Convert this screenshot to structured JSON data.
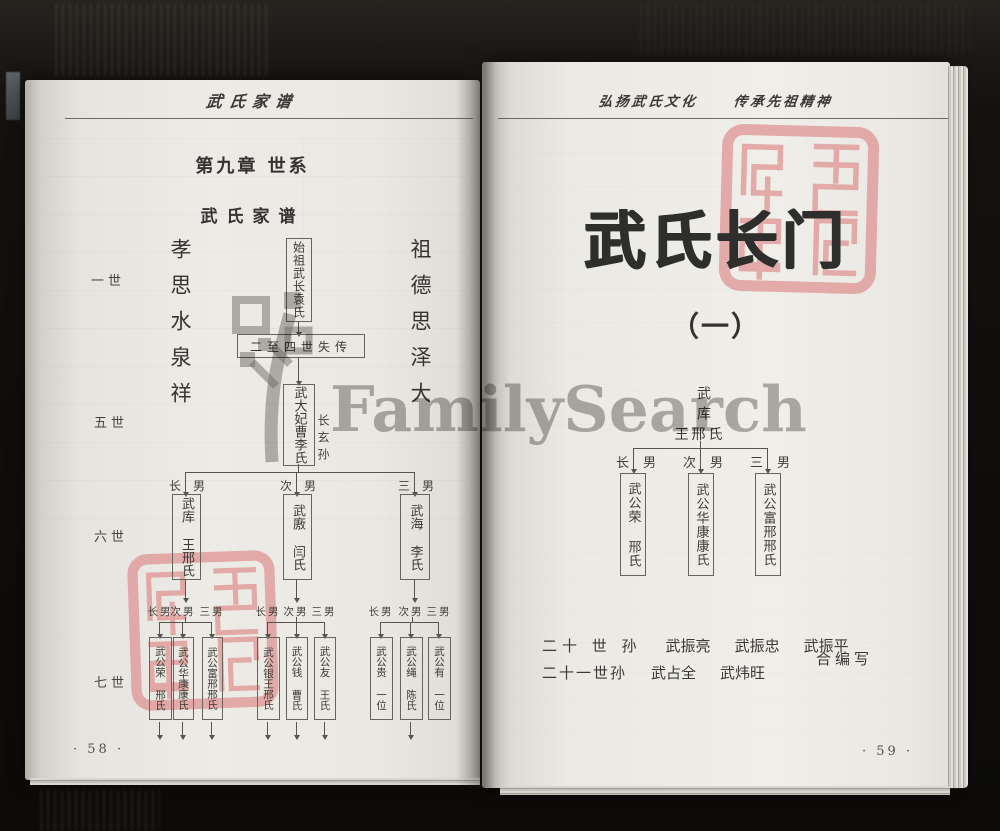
{
  "left_page": {
    "running_header": "武氏家谱",
    "chapter_title": "第九章 世系",
    "section_title": "武氏家谱",
    "left_motto": "孝思水泉祥",
    "right_motto": "祖德思泽大",
    "generation_labels": {
      "gen1": "一世",
      "gen5": "五世",
      "gen6": "六世",
      "gen7": "七世"
    },
    "tree": {
      "founder": "始祖武长袁氏",
      "lost_generations": "二至四世失传",
      "gen5_name": "武大妃曹李氏",
      "gen5_note": "长玄孙",
      "gen6": [
        {
          "relation": "长男",
          "name": "武库 王邢氏"
        },
        {
          "relation": "次男",
          "name": "武廒 闫氏"
        },
        {
          "relation": "三男",
          "name": "武海 李氏"
        }
      ],
      "gen7_relations": [
        "长男",
        "次男",
        "三男"
      ],
      "gen7_groups": [
        {
          "boxes": [
            "武公荣 邢氏",
            "武公华康康氏",
            "武公富邢邢氏"
          ]
        },
        {
          "boxes": [
            "武公银王邢氏",
            "武公钱 曹氏",
            "武公友 王氏"
          ]
        },
        {
          "boxes": [
            "武公贵 一位",
            "武公绳 陈氏",
            "武公有 一位"
          ]
        }
      ]
    },
    "page_number": "· 58 ·"
  },
  "right_page": {
    "running_header_left": "弘扬武氏文化",
    "running_header_right": "传承先祖精神",
    "title": "武氏长门",
    "subtitle": "（一）",
    "tree": {
      "root_name": "武库",
      "root_wives": "王邢氏",
      "relations": [
        "长男",
        "次男",
        "三男"
      ],
      "children": [
        "武公荣 邢氏",
        "武公华康康氏",
        "武公富邢邢氏"
      ]
    },
    "colophon": {
      "line1_prefix": "二十 世 孙",
      "line1_names": [
        "武振亮",
        "武振忠",
        "武振平"
      ],
      "suffix": "合编写",
      "line2_prefix": "二十一世孙",
      "line2_names": [
        "武占全",
        "武炜旺"
      ]
    },
    "page_number": "· 59 ·"
  },
  "watermark": {
    "text": "FamilySearch",
    "color": "#706e68"
  },
  "seal": {
    "color": "#dd8b8b"
  }
}
